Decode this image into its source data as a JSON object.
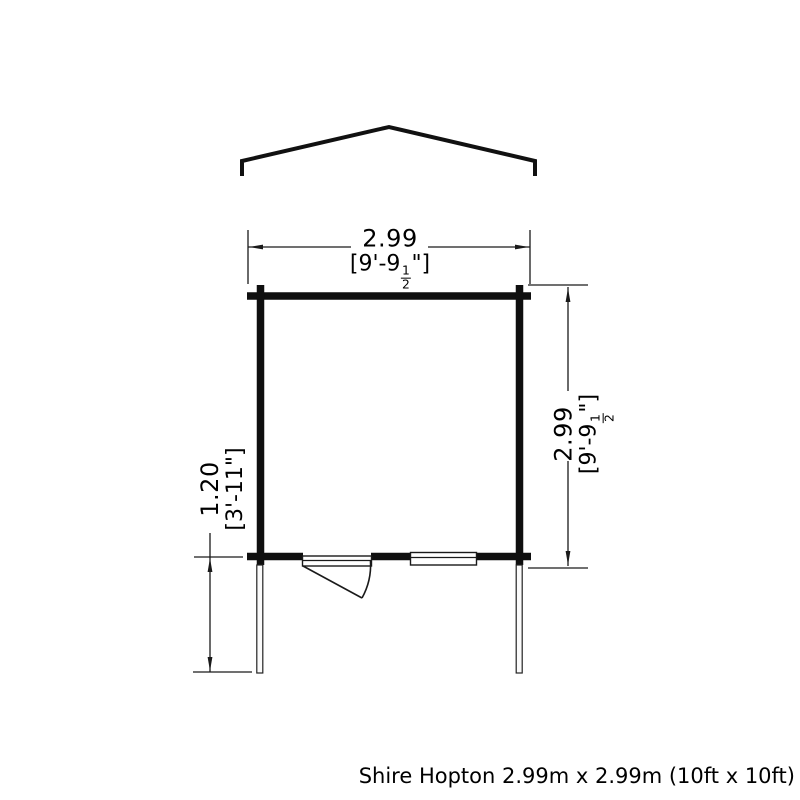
{
  "caption": {
    "text": "Shire Hopton 2.99m x 2.99m (10ft x 10ft)"
  },
  "plan": {
    "width_dim": {
      "metric": "2.99",
      "imperial_open": "[9'-9",
      "fraction_numerator": "1",
      "fraction_denominator": "2",
      "imperial_close": "\"]"
    },
    "depth_dim": {
      "metric": "2.99",
      "imperial_open": "[9'-9",
      "fraction_numerator": "1",
      "fraction_denominator": "2",
      "imperial_close": "\"]"
    },
    "porch_dim": {
      "metric": "1.20",
      "imperial": "[3'-11\"]"
    }
  },
  "colors": {
    "background": "#ffffff",
    "wall": "#0f0f0f",
    "roof": "#111111",
    "dimension_line": "#1a1a1a",
    "text": "#000000"
  }
}
